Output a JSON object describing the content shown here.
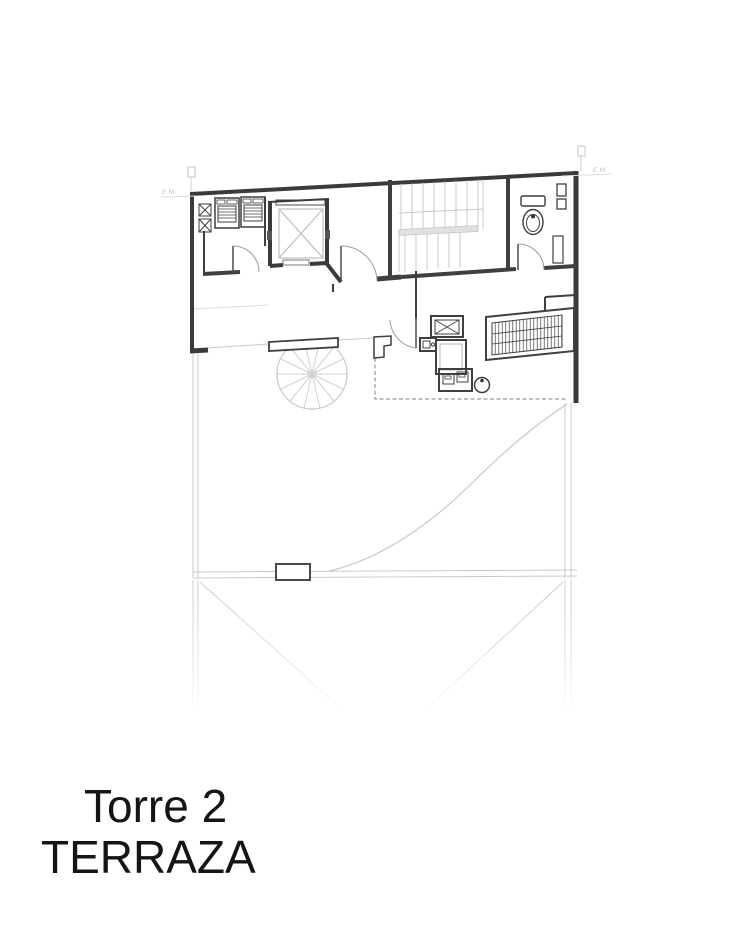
{
  "title": {
    "line1": "Torre 2",
    "line2": "TERRAZA"
  },
  "markers": {
    "left_label": "E.M.",
    "right_label": "E.M."
  },
  "colors": {
    "background": "#ffffff",
    "wall_dark": "#3a3a3a",
    "line_light": "#c7c9c9",
    "door_arc": "#9a9a9a",
    "title_text": "#151515",
    "marker_text": "#c2c4c4"
  }
}
